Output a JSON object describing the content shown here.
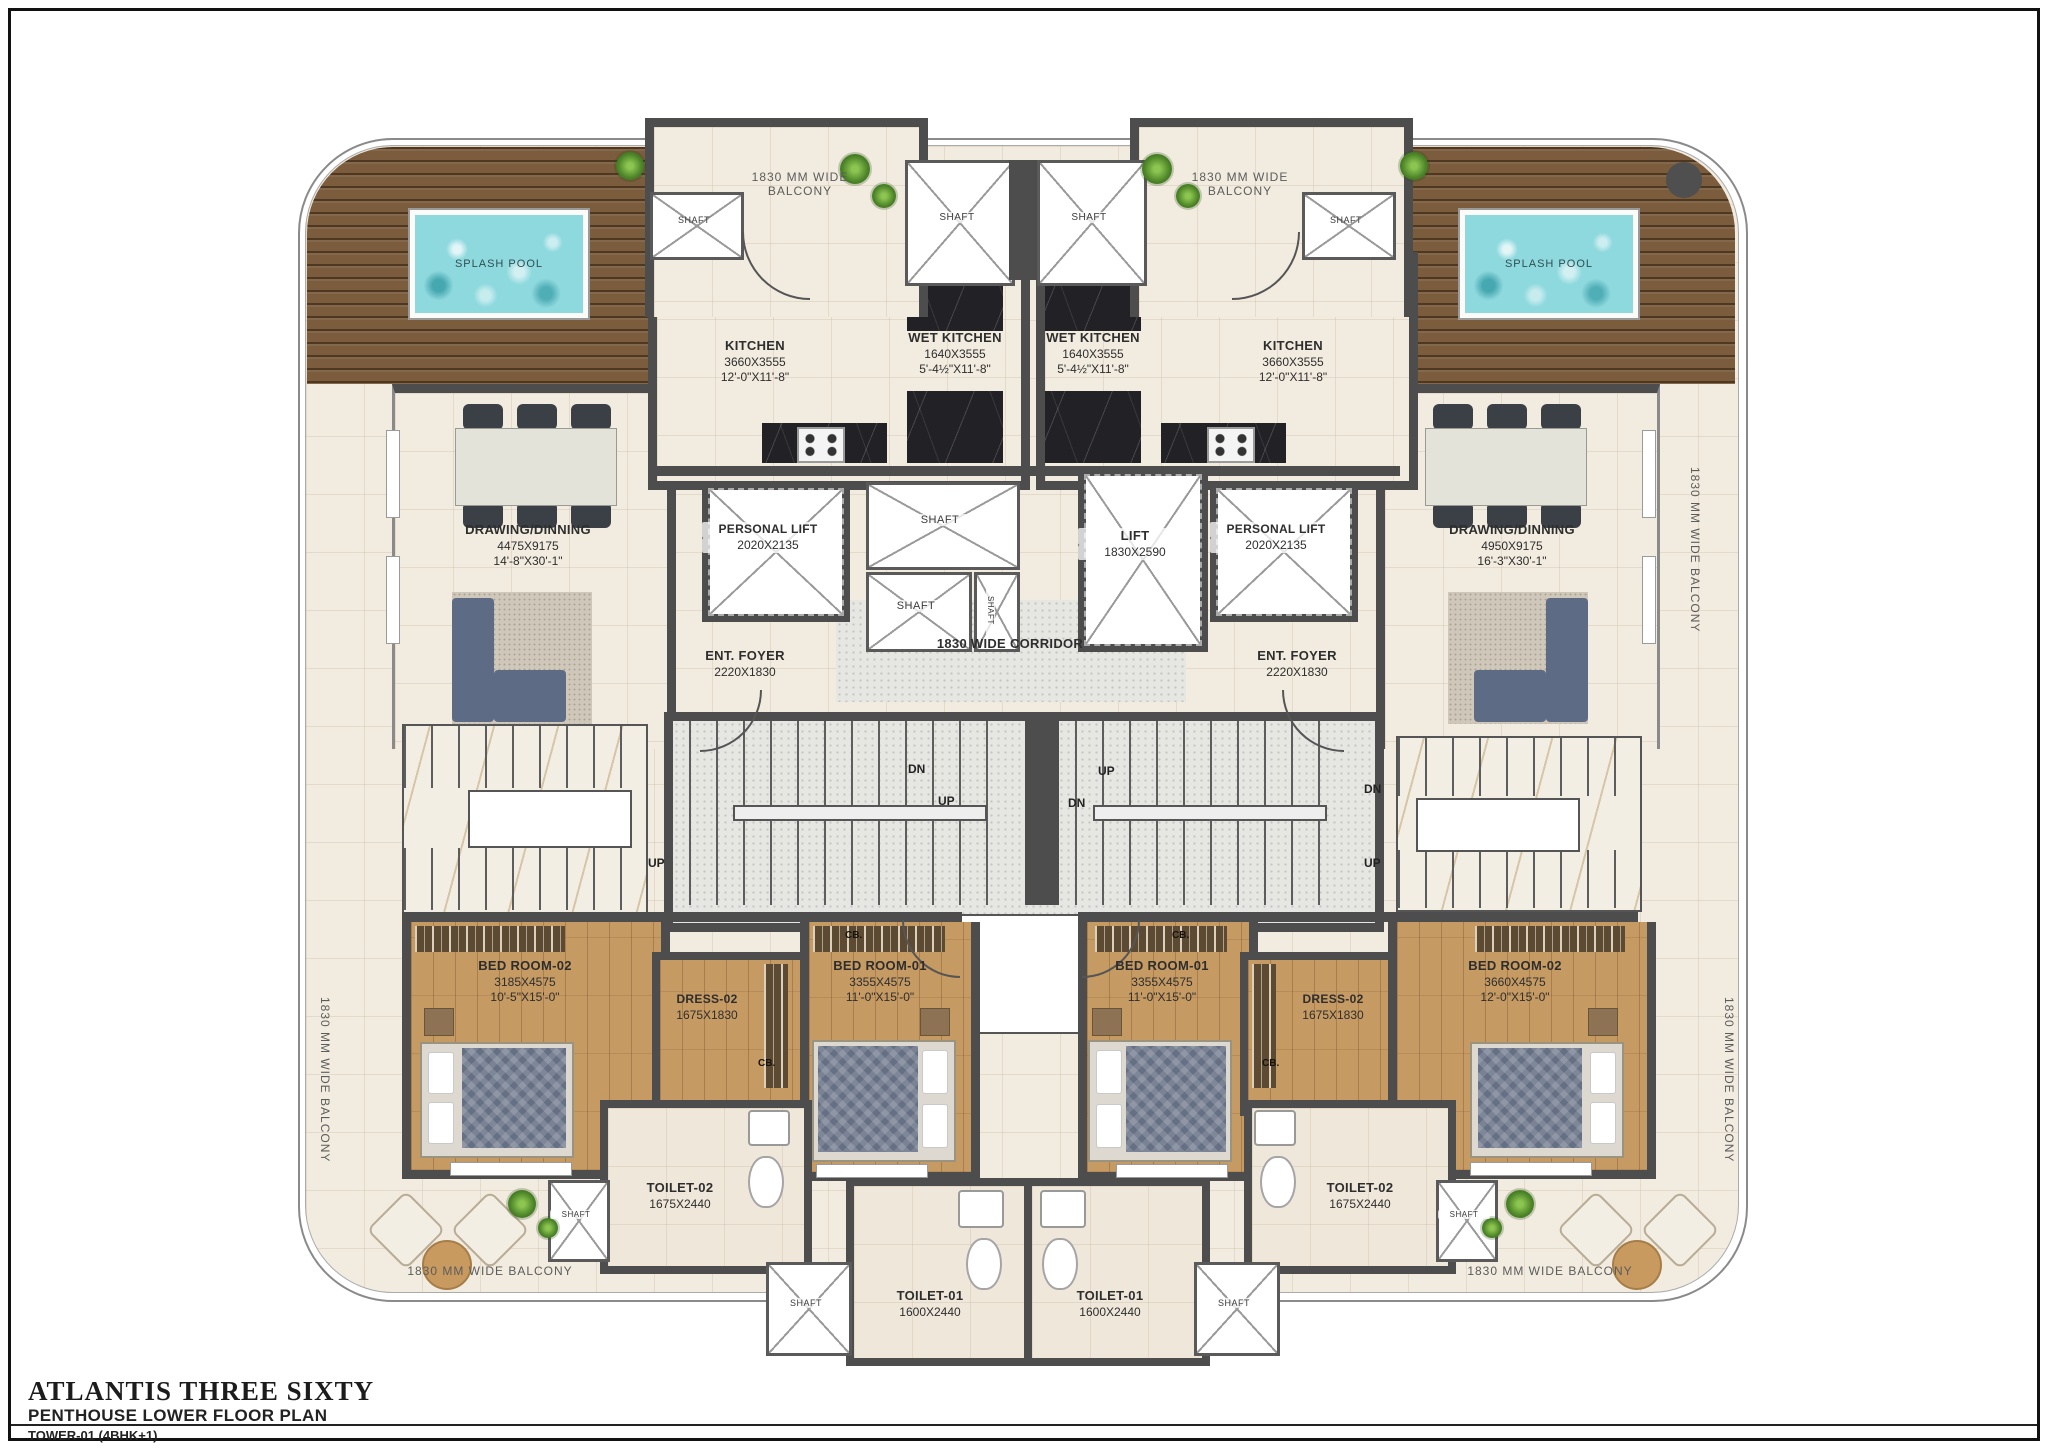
{
  "title_block": {
    "project": "ATLANTIS THREE SIXTY",
    "plan_name": "PENTHOUSE LOWER FLOOR PLAN",
    "tower": "TOWER-01 (4BHK+1)"
  },
  "labels": {
    "balcony": "1830 MM WIDE BALCONY",
    "corridor": "1830 WIDE CORRIDOR",
    "splash_pool": "SPLASH POOL",
    "shaft": "SHAFT",
    "up": "UP",
    "dn": "DN",
    "cb": "CB."
  },
  "rooms": {
    "kitchen": {
      "name": "KITCHEN",
      "mm": "3660X3555",
      "ft": "12'-0\"X11'-8\""
    },
    "wet_kitchen": {
      "name": "WET KITCHEN",
      "mm": "1640X3555",
      "ft": "5'-4½\"X11'-8\""
    },
    "drawing_left": {
      "name": "DRAWING/DINNING",
      "mm": "4475X9175",
      "ft": "14'-8\"X30'-1\""
    },
    "drawing_right": {
      "name": "DRAWING/DINNING",
      "mm": "4950X9175",
      "ft": "16'-3\"X30'-1\""
    },
    "personal_lift": {
      "name": "PERSONAL LIFT",
      "mm": "2020X2135"
    },
    "lift": {
      "name": "LIFT",
      "mm": "1830X2590"
    },
    "foyer": {
      "name": "ENT. FOYER",
      "mm": "2220X1830"
    },
    "bed1": {
      "name": "BED ROOM-01",
      "mm": "3355X4575",
      "ft": "11'-0\"X15'-0\""
    },
    "bed2_left": {
      "name": "BED ROOM-02",
      "mm": "3185X4575",
      "ft": "10'-5\"X15'-0\""
    },
    "bed2_right": {
      "name": "BED ROOM-02",
      "mm": "3660X4575",
      "ft": "12'-0\"X15'-0\""
    },
    "dress2": {
      "name": "DRESS-02",
      "mm": "1675X1830"
    },
    "toilet1": {
      "name": "TOILET-01",
      "mm": "1600X2440"
    },
    "toilet2": {
      "name": "TOILET-02",
      "mm": "1675X2440"
    }
  },
  "colors": {
    "wall": "#4d4d4d",
    "pool_water": "#8ed9de",
    "deck_wood": "#7b5c3d",
    "floor_wood": "#c59a63",
    "dark_marble": "#222226",
    "cream_tile": "#f2ebdf"
  }
}
